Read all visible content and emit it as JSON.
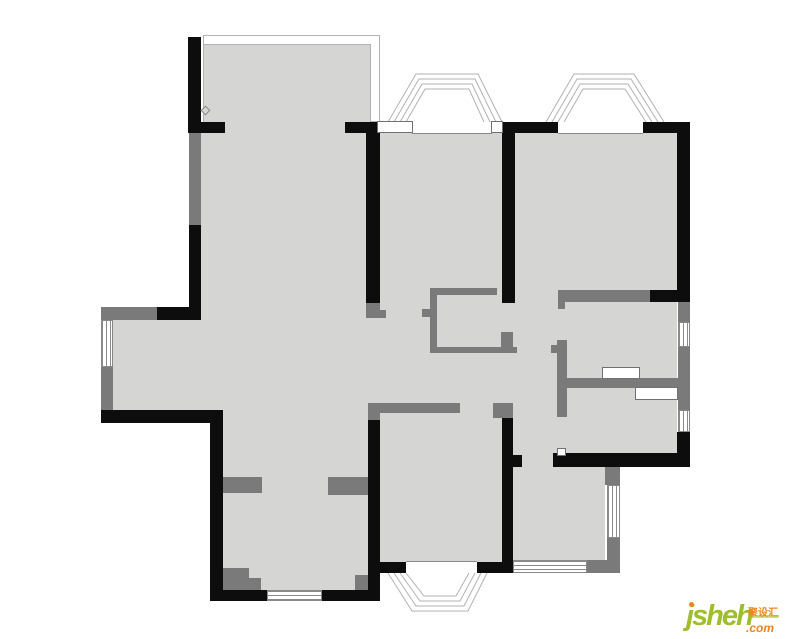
{
  "page": {
    "width": 800,
    "height": 639,
    "background": "#ffffff"
  },
  "logo": {
    "main": "jsheh",
    "tld": ".com",
    "cn": "聚设汇",
    "green": "#9fbe2c",
    "orange": "#ee851d"
  },
  "plan": {
    "palette": {
      "floor": "#d5d5d4",
      "wall_black": "#0d0d0d",
      "wall_gray": "#7a7a7a",
      "thin_line": "#b2b2b2",
      "window_line": "#8a8a8a",
      "panel_line": "#707070"
    },
    "balcony": {
      "outer": [
        203,
        35,
        177,
        87
      ],
      "inner": [
        204,
        44,
        167,
        89
      ]
    },
    "floors": [
      [
        201,
        133,
        22,
        290
      ],
      [
        113,
        320,
        88,
        90
      ],
      [
        223,
        133,
        290,
        429
      ],
      [
        223,
        562,
        145,
        28
      ],
      [
        513,
        133,
        164,
        320
      ],
      [
        513,
        453,
        92,
        107
      ]
    ],
    "hairlines": [
      [
        412,
        133,
        80,
        1
      ],
      [
        558,
        133,
        85,
        1
      ],
      [
        406,
        561,
        71,
        1
      ]
    ],
    "gray_walls": [
      [
        189,
        133,
        12,
        92
      ],
      [
        101,
        307,
        56,
        13
      ],
      [
        101,
        367,
        12,
        43
      ],
      [
        366,
        303,
        14,
        15
      ],
      [
        380,
        310,
        6,
        8
      ],
      [
        368,
        403,
        92,
        10
      ],
      [
        368,
        413,
        12,
        7
      ],
      [
        493,
        403,
        20,
        15
      ],
      [
        223,
        477,
        39,
        16
      ],
      [
        328,
        477,
        40,
        18
      ],
      [
        223,
        568,
        26,
        22
      ],
      [
        249,
        578,
        12,
        12
      ],
      [
        355,
        575,
        13,
        15
      ],
      [
        430,
        288,
        67,
        7
      ],
      [
        430,
        288,
        7,
        65
      ],
      [
        430,
        347,
        87,
        6
      ],
      [
        422,
        309,
        8,
        8
      ],
      [
        501,
        332,
        12,
        15
      ],
      [
        557,
        340,
        10,
        77
      ],
      [
        551,
        345,
        6,
        8
      ],
      [
        567,
        378,
        111,
        10
      ],
      [
        558,
        290,
        92,
        12
      ],
      [
        558,
        302,
        7,
        7
      ],
      [
        678,
        298,
        12,
        24
      ],
      [
        678,
        347,
        12,
        63
      ],
      [
        605,
        467,
        15,
        18
      ],
      [
        607,
        538,
        13,
        23
      ],
      [
        587,
        560,
        33,
        13
      ]
    ],
    "black_walls": [
      [
        188,
        37,
        13,
        96
      ],
      [
        188,
        122,
        37,
        11
      ],
      [
        345,
        122,
        35,
        11
      ],
      [
        366,
        122,
        14,
        181
      ],
      [
        502,
        122,
        56,
        11
      ],
      [
        502,
        122,
        13,
        181
      ],
      [
        643,
        122,
        47,
        11
      ],
      [
        677,
        122,
        13,
        176
      ],
      [
        189,
        225,
        12,
        95
      ],
      [
        157,
        307,
        44,
        13
      ],
      [
        101,
        410,
        122,
        13
      ],
      [
        210,
        423,
        13,
        178
      ],
      [
        210,
        590,
        57,
        11
      ],
      [
        322,
        590,
        58,
        11
      ],
      [
        368,
        420,
        12,
        181
      ],
      [
        380,
        562,
        26,
        11
      ],
      [
        477,
        562,
        36,
        11
      ],
      [
        502,
        418,
        11,
        155
      ],
      [
        513,
        455,
        9,
        12
      ],
      [
        553,
        453,
        137,
        14
      ],
      [
        677,
        432,
        13,
        35
      ],
      [
        650,
        290,
        40,
        12
      ]
    ],
    "windows": [
      {
        "r": [
          101,
          320,
          12,
          47
        ],
        "o": "v"
      },
      {
        "r": [
          267,
          590,
          55,
          11
        ],
        "o": "h"
      },
      {
        "r": [
          678,
          322,
          12,
          25
        ],
        "o": "v"
      },
      {
        "r": [
          678,
          410,
          12,
          22
        ],
        "o": "v"
      },
      {
        "r": [
          607,
          485,
          13,
          53
        ],
        "o": "v"
      },
      {
        "r": [
          513,
          560,
          74,
          13
        ],
        "o": "h"
      }
    ],
    "panels": [
      [
        377,
        121,
        36,
        12
      ],
      [
        491,
        121,
        12,
        12
      ],
      [
        602,
        367,
        38,
        12
      ],
      [
        635,
        387,
        43,
        13
      ],
      [
        557,
        448,
        9,
        8
      ]
    ],
    "bays": [
      {
        "lines": [
          [
            [
              388,
              122
            ],
            [
              416,
              74
            ],
            [
              478,
              74
            ],
            [
              502,
              122
            ]
          ],
          [
            [
              394,
              122
            ],
            [
              419,
              79
            ],
            [
              475,
              79
            ],
            [
              496,
              122
            ]
          ],
          [
            [
              400,
              122
            ],
            [
              422,
              84
            ],
            [
              472,
              84
            ],
            [
              490,
              122
            ]
          ],
          [
            [
              406,
              122
            ],
            [
              425,
              89
            ],
            [
              469,
              89
            ],
            [
              484,
              122
            ]
          ]
        ]
      },
      {
        "lines": [
          [
            [
              546,
              122
            ],
            [
              574,
              74
            ],
            [
              634,
              74
            ],
            [
              664,
              122
            ]
          ],
          [
            [
              552,
              122
            ],
            [
              577,
              79
            ],
            [
              631,
              79
            ],
            [
              658,
              122
            ]
          ],
          [
            [
              558,
              122
            ],
            [
              580,
              84
            ],
            [
              628,
              84
            ],
            [
              652,
              122
            ]
          ],
          [
            [
              564,
              122
            ],
            [
              583,
              89
            ],
            [
              625,
              89
            ],
            [
              646,
              122
            ]
          ]
        ]
      },
      {
        "lines": [
          [
            [
              388,
              573
            ],
            [
              412,
              611
            ],
            [
              468,
              611
            ],
            [
              487,
              573
            ]
          ],
          [
            [
              394,
              573
            ],
            [
              416,
              606
            ],
            [
              464,
              606
            ],
            [
              481,
              573
            ]
          ],
          [
            [
              400,
              573
            ],
            [
              420,
              601
            ],
            [
              460,
              601
            ],
            [
              475,
              573
            ]
          ],
          [
            [
              406,
              573
            ],
            [
              424,
              596
            ],
            [
              456,
              596
            ],
            [
              469,
              573
            ]
          ]
        ]
      }
    ],
    "marker": {
      "x": 205,
      "y": 110,
      "size": 7
    }
  }
}
